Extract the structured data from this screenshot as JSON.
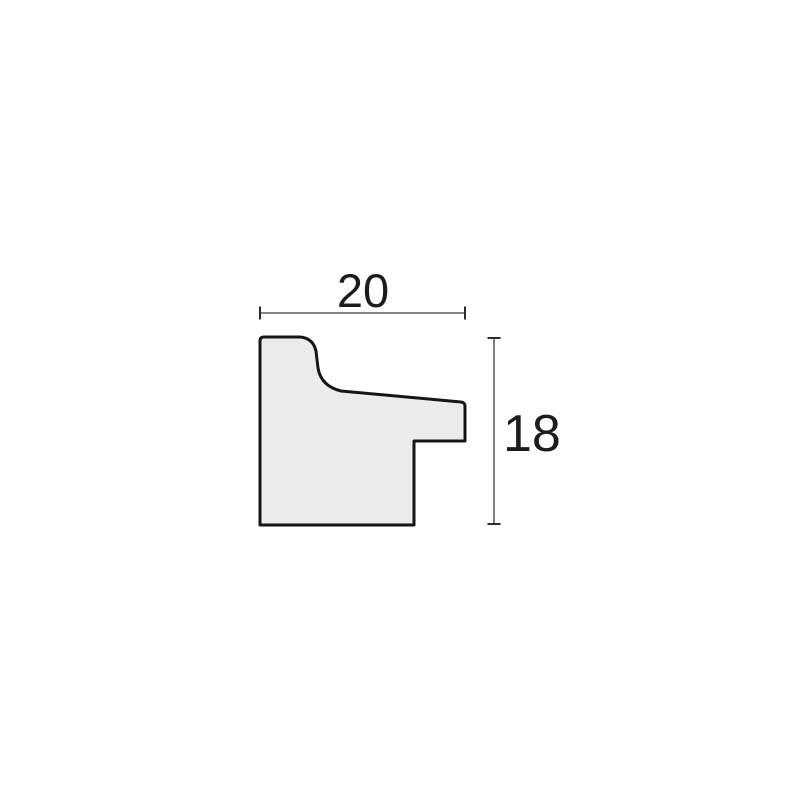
{
  "diagram": {
    "type": "technical-profile-cross-section",
    "subject": "picture frame moulding profile",
    "background_color": "#ffffff",
    "profile": {
      "fill_color": "#ebebeb",
      "outline_color": "#151515"
    },
    "dimensions": {
      "width": {
        "value": "20",
        "orientation": "horizontal",
        "position": "top"
      },
      "height": {
        "value": "18",
        "orientation": "vertical",
        "position": "right"
      }
    }
  }
}
